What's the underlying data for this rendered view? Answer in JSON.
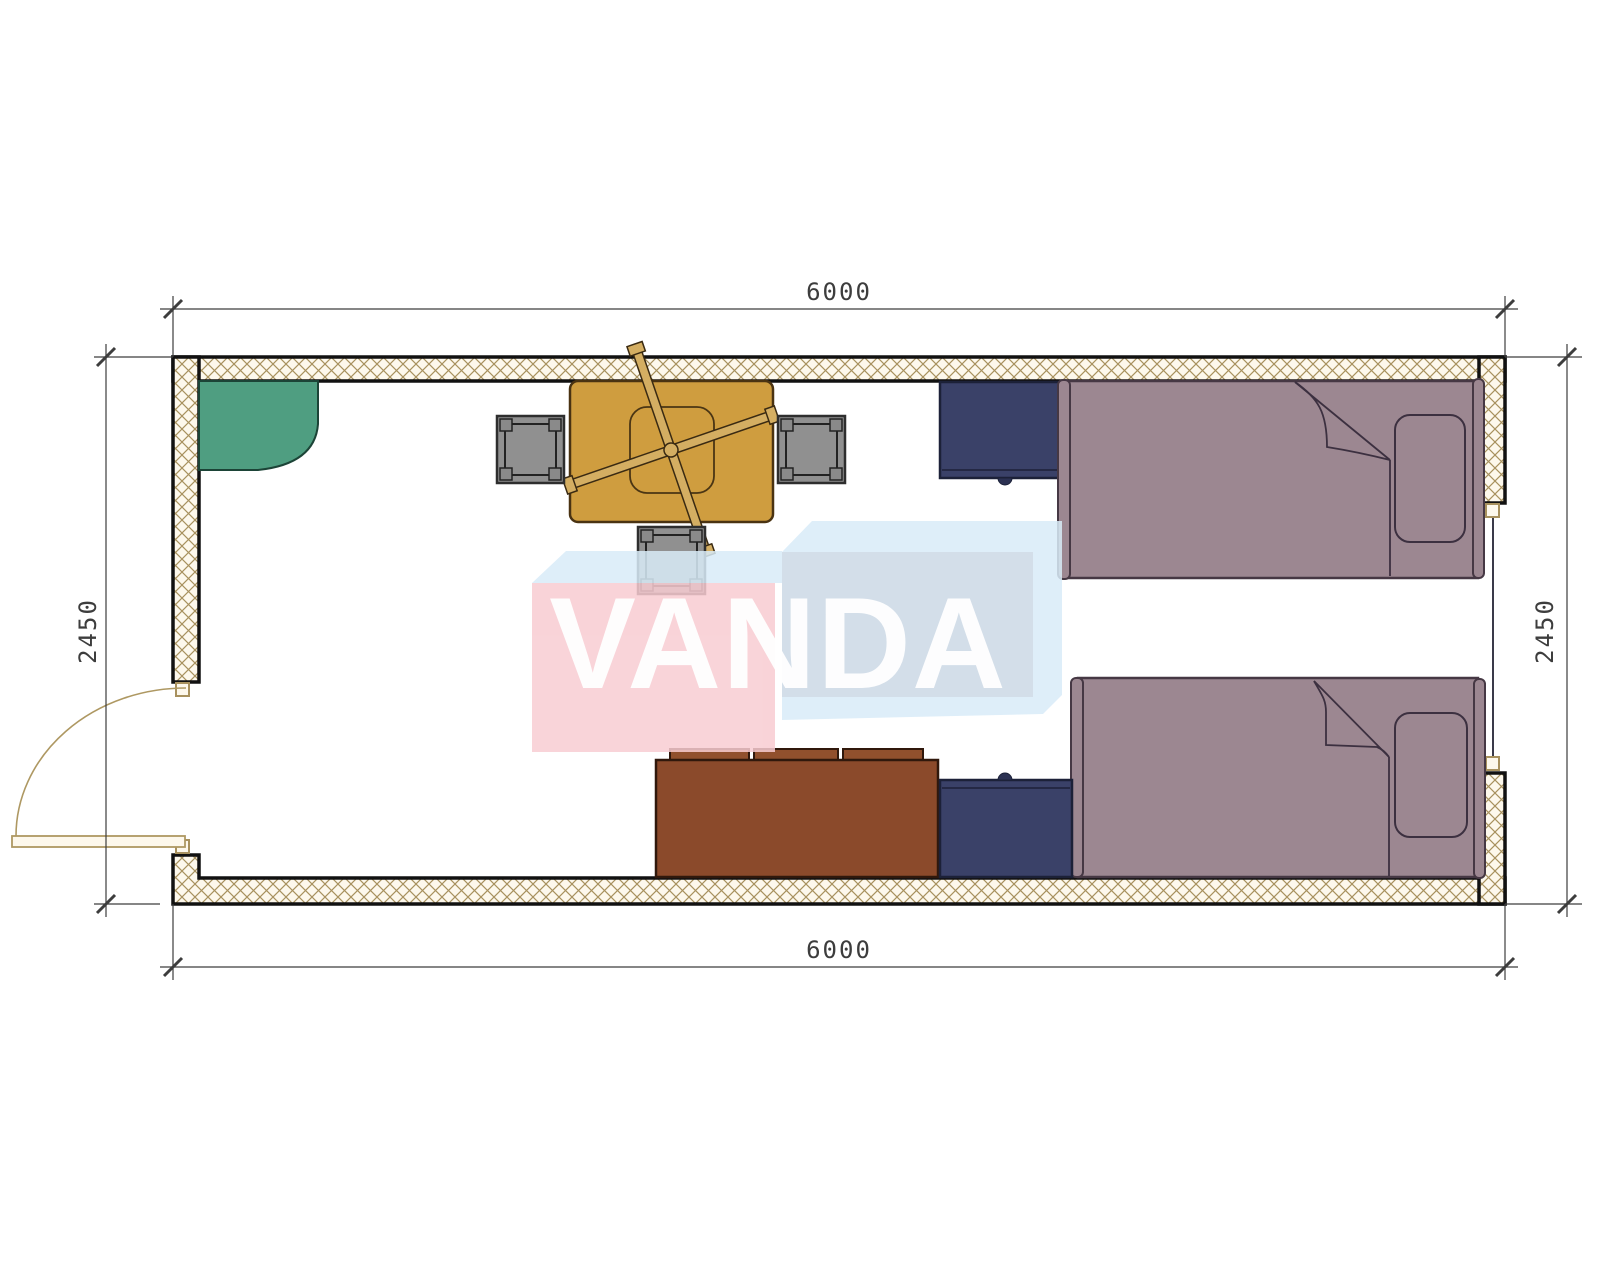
{
  "title": "container-house-floor-plan",
  "watermark": {
    "brand": "VANDA",
    "pink": "#f8ccd2",
    "light_blue": "#d9ecf8",
    "inner_blue": "#ccd9e6"
  },
  "dimensions": {
    "top": "6000",
    "bottom": "6000",
    "left": "2450",
    "right": "2450",
    "units": "mm"
  },
  "walls": {
    "hatch_background": "#fdf8ec",
    "hatch_line": "#a8915e",
    "outline": "#111111",
    "openings": [
      "door-left-wall",
      "window-right-wall"
    ]
  },
  "furniture": [
    {
      "name": "corner-unit",
      "color": "#4f9e81"
    },
    {
      "name": "table-with-fan",
      "color": "#cf9d3f"
    },
    {
      "name": "stool-left",
      "color": "#909090"
    },
    {
      "name": "stool-right",
      "color": "#909090"
    },
    {
      "name": "stool-bottom",
      "color": "#7d8c96"
    },
    {
      "name": "nightstand-top",
      "color": "#3a4168"
    },
    {
      "name": "nightstand-bottom",
      "color": "#3a4168"
    },
    {
      "name": "bed-top",
      "color": "#9c8791"
    },
    {
      "name": "bed-bottom",
      "color": "#9c8791"
    },
    {
      "name": "sofa",
      "color": "#8b4a2b"
    }
  ]
}
